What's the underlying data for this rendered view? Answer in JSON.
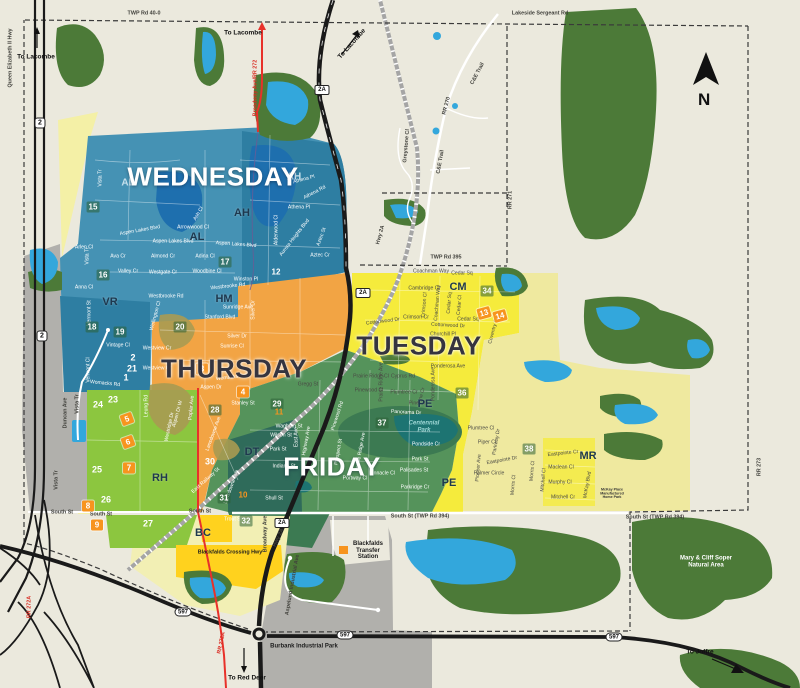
{
  "compass": {
    "label": "N"
  },
  "colors": {
    "background": "#EBE9DD",
    "forest": "#4C7A38",
    "water": "#33A7DC",
    "water_dark": "#1E6FAE",
    "pond_teal": "#1D7472",
    "wednesday": "#4592B4",
    "wednesday_dark": "#2E7EA2",
    "thursday": "#F2A444",
    "olive": "#A89B52",
    "tuesday": "#F5EB3C",
    "tuesday_pale": "#EFE99F",
    "friday": "#55935B",
    "friday_dark": "#3C7A52",
    "downtown": "#2F6B5A",
    "green_bright": "#8CC63F",
    "yellow_bright": "#FFD21E",
    "bc_pale": "#F2EFB4",
    "pale_strip": "#F4F0A6",
    "gray": "#B1B0AC",
    "road_red": "#E8312A",
    "orange_marker": "#F7941E",
    "railway": "#A5A5A5"
  },
  "day_zones": [
    {
      "id": "wednesday",
      "label": "WEDNESDAY",
      "x": 213,
      "y": 177,
      "color": "#4592B4",
      "tone": "light"
    },
    {
      "id": "thursday",
      "label": "THURSDAY",
      "x": 234,
      "y": 369,
      "color": "#F2A444",
      "tone": "dark"
    },
    {
      "id": "tuesday",
      "label": "TUESDAY",
      "x": 419,
      "y": 346,
      "color": "#F5EB3C",
      "tone": "dark"
    },
    {
      "id": "friday",
      "label": "FRIDAY",
      "x": 332,
      "y": 467,
      "color": "#55935B",
      "tone": "light"
    }
  ],
  "area_codes": [
    {
      "t": "AL",
      "x": 128,
      "y": 183,
      "style": "light"
    },
    {
      "t": "AH",
      "x": 294,
      "y": 177,
      "style": "light"
    },
    {
      "t": "AH",
      "x": 242,
      "y": 213,
      "style": "dark"
    },
    {
      "t": "AL",
      "x": 197,
      "y": 237,
      "style": "dark"
    },
    {
      "t": "VR",
      "x": 110,
      "y": 302,
      "style": "dark"
    },
    {
      "t": "HM",
      "x": 224,
      "y": 299,
      "style": "dark"
    },
    {
      "t": "RH",
      "x": 160,
      "y": 478,
      "style": "dark"
    },
    {
      "t": "DT",
      "x": 252,
      "y": 452,
      "style": "dark"
    },
    {
      "t": "BC",
      "x": 203,
      "y": 533,
      "style": "dark"
    },
    {
      "t": "PE",
      "x": 425,
      "y": 404,
      "style": "dark"
    },
    {
      "t": "PE",
      "x": 449,
      "y": 483,
      "style": "dark"
    },
    {
      "t": "CM",
      "x": 458,
      "y": 287,
      "style": "dark"
    },
    {
      "t": "MR",
      "x": 588,
      "y": 456,
      "style": "dark"
    }
  ],
  "markers": [
    {
      "t": "12",
      "x": 276,
      "y": 272,
      "style": "teal"
    },
    {
      "t": "15",
      "x": 93,
      "y": 207,
      "style": "park"
    },
    {
      "t": "16",
      "x": 103,
      "y": 275,
      "style": "park"
    },
    {
      "t": "17",
      "x": 225,
      "y": 262,
      "style": "park"
    },
    {
      "t": "18",
      "x": 92,
      "y": 327,
      "style": "park"
    },
    {
      "t": "19",
      "x": 120,
      "y": 332,
      "style": "park"
    },
    {
      "t": "20",
      "x": 180,
      "y": 327,
      "style": "park"
    },
    {
      "t": "28",
      "x": 215,
      "y": 410,
      "style": "park"
    },
    {
      "t": "29",
      "x": 277,
      "y": 404,
      "style": "park"
    },
    {
      "t": "31",
      "x": 224,
      "y": 498,
      "style": "park"
    },
    {
      "t": "32",
      "x": 246,
      "y": 521,
      "style": "park"
    },
    {
      "t": "34",
      "x": 487,
      "y": 291,
      "style": "park"
    },
    {
      "t": "36",
      "x": 462,
      "y": 393,
      "style": "park"
    },
    {
      "t": "37",
      "x": 382,
      "y": 423,
      "style": "park"
    },
    {
      "t": "38",
      "x": 529,
      "y": 449,
      "style": "park"
    },
    {
      "t": "1",
      "x": 126,
      "y": 377,
      "style": "plain"
    },
    {
      "t": "2",
      "x": 133,
      "y": 357,
      "style": "plain"
    },
    {
      "t": "21",
      "x": 132,
      "y": 368,
      "style": "plain"
    },
    {
      "t": "23",
      "x": 113,
      "y": 399,
      "style": "plain"
    },
    {
      "t": "24",
      "x": 98,
      "y": 404,
      "style": "plain"
    },
    {
      "t": "25",
      "x": 97,
      "y": 469,
      "style": "plain"
    },
    {
      "t": "26",
      "x": 106,
      "y": 499,
      "style": "plain"
    },
    {
      "t": "27",
      "x": 148,
      "y": 523,
      "style": "plain"
    },
    {
      "t": "30",
      "x": 210,
      "y": 461,
      "style": "plain"
    },
    {
      "t": "3",
      "x": 202,
      "y": 369,
      "style": "orange"
    },
    {
      "t": "4",
      "x": 243,
      "y": 392,
      "style": "orange"
    },
    {
      "t": "5",
      "x": 127,
      "y": 419,
      "style": "orange",
      "r": -20
    },
    {
      "t": "6",
      "x": 128,
      "y": 442,
      "style": "orange",
      "r": -20
    },
    {
      "t": "7",
      "x": 129,
      "y": 468,
      "style": "orange"
    },
    {
      "t": "8",
      "x": 88,
      "y": 506,
      "style": "orange"
    },
    {
      "t": "9",
      "x": 97,
      "y": 525,
      "style": "orange"
    },
    {
      "t": "13",
      "x": 484,
      "y": 313,
      "style": "orange",
      "r": -15
    },
    {
      "t": "14",
      "x": 500,
      "y": 316,
      "style": "orange",
      "r": -15
    },
    {
      "t": "10",
      "x": 243,
      "y": 495,
      "style": "otext"
    },
    {
      "t": "11",
      "x": 279,
      "y": 412,
      "style": "otext"
    }
  ],
  "badges": [
    {
      "t": "2",
      "x": 40,
      "y": 123,
      "shape": "sq"
    },
    {
      "t": "2",
      "x": 42,
      "y": 336,
      "shape": "sq"
    },
    {
      "t": "2A",
      "x": 322,
      "y": 90,
      "shape": "rect"
    },
    {
      "t": "2A",
      "x": 363,
      "y": 293,
      "shape": "rect"
    },
    {
      "t": "2A",
      "x": 282,
      "y": 523,
      "shape": "rect"
    },
    {
      "t": "597",
      "x": 183,
      "y": 612,
      "shape": "oval"
    },
    {
      "t": "597",
      "x": 345,
      "y": 635,
      "shape": "oval"
    },
    {
      "t": "597",
      "x": 614,
      "y": 637,
      "shape": "oval"
    }
  ],
  "road_labels": [
    {
      "t": "Queen Elizabeth II Hwy",
      "x": 11,
      "y": 58,
      "r": -90
    },
    {
      "t": "TWP Rd 40-0",
      "x": 144,
      "y": 14
    },
    {
      "t": "Lakeside Sergeant Rd",
      "x": 540,
      "y": 14
    },
    {
      "t": "TWP Rd 395",
      "x": 446,
      "y": 258
    },
    {
      "t": "RR 271",
      "x": 511,
      "y": 200,
      "r": -90
    },
    {
      "t": "RR 273",
      "x": 760,
      "y": 467,
      "r": -90
    },
    {
      "t": "RR 270",
      "x": 447,
      "y": 106,
      "r": -75
    },
    {
      "t": "C&E Trail",
      "x": 478,
      "y": 74,
      "r": -62
    },
    {
      "t": "C&E Trail",
      "x": 441,
      "y": 162,
      "r": -80
    },
    {
      "t": "Greystone Cl",
      "x": 407,
      "y": 146,
      "r": -85
    },
    {
      "t": "Hwy 2A",
      "x": 381,
      "y": 235,
      "r": -75
    },
    {
      "t": "Hwy 2A",
      "x": 279,
      "y": 538,
      "r": -65
    },
    {
      "t": "South St",
      "x": 62,
      "y": 513
    },
    {
      "t": "South St",
      "x": 101,
      "y": 515
    },
    {
      "t": "South St",
      "x": 200,
      "y": 512
    },
    {
      "t": "South St (TWP Rd 394)",
      "x": 420,
      "y": 517
    },
    {
      "t": "South St (TWP Rd 394)",
      "x": 655,
      "y": 518
    },
    {
      "t": "Duncan Ave",
      "x": 66,
      "y": 413,
      "r": -90
    },
    {
      "t": "Vista Tr",
      "x": 78,
      "y": 404,
      "r": -90
    },
    {
      "t": "Vista Tr",
      "x": 57,
      "y": 480,
      "r": -90
    },
    {
      "t": "Broadway Ave/RR 272",
      "x": 256,
      "y": 88,
      "r": -90,
      "c": "r"
    },
    {
      "t": "RR 272A",
      "x": 222,
      "y": 643,
      "r": -78,
      "c": "r"
    },
    {
      "t": "RR 272A",
      "x": 30,
      "y": 607,
      "r": -90,
      "c": "r"
    },
    {
      "t": "Broadway Ave",
      "x": 266,
      "y": 534,
      "r": -90
    },
    {
      "t": "Aspelund Industrial Ave",
      "x": 293,
      "y": 585,
      "r": -80
    },
    {
      "t": "Blackfalds Crossing Hwy",
      "x": 230,
      "y": 553,
      "c": "poi"
    }
  ],
  "pois": [
    {
      "t": "Blackfalds\nTransfer\nStation",
      "x": 368,
      "y": 551,
      "c": "poi"
    },
    {
      "t": "Burbank Industrial Park",
      "x": 304,
      "y": 647,
      "c": "poi"
    },
    {
      "t": "Mary & Cliff Soper\nNatural Area",
      "x": 706,
      "y": 562,
      "c": "poi-w"
    },
    {
      "t": "Centennial\nPark",
      "x": 424,
      "y": 427,
      "c": "poi-teal"
    },
    {
      "t": "McKay Place\nManufactured\nHome Park",
      "x": 612,
      "y": 494,
      "c": "poi-tiny",
      "k": 0.6
    }
  ],
  "directions": [
    {
      "t": "To Lacombe",
      "x": 36,
      "y": 57
    },
    {
      "t": "To Lacombe",
      "x": 243,
      "y": 33
    },
    {
      "t": "To Lacombe",
      "x": 352,
      "y": 44,
      "r": -48
    },
    {
      "t": "To Red Deer",
      "x": 247,
      "y": 678
    },
    {
      "t": "To Joffre",
      "x": 700,
      "y": 652
    }
  ],
  "streets": [
    {
      "t": "Vista Tr",
      "x": 101,
      "y": 178,
      "r": -90
    },
    {
      "t": "Vista Tr",
      "x": 88,
      "y": 256,
      "r": -90
    },
    {
      "t": "Anna Cl",
      "x": 84,
      "y": 288
    },
    {
      "t": "Arlen Cl",
      "x": 84,
      "y": 248
    },
    {
      "t": "Ava Cr",
      "x": 118,
      "y": 257
    },
    {
      "t": "Valley Cr",
      "x": 128,
      "y": 272
    },
    {
      "t": "Westgate Cr",
      "x": 163,
      "y": 273
    },
    {
      "t": "Almond Cr",
      "x": 163,
      "y": 257
    },
    {
      "t": "Adina Cl",
      "x": 205,
      "y": 257
    },
    {
      "t": "Woodbine Cl",
      "x": 207,
      "y": 272
    },
    {
      "t": "Arrowwood Cl",
      "x": 193,
      "y": 228
    },
    {
      "t": "Ash Cl",
      "x": 199,
      "y": 214,
      "r": -60
    },
    {
      "t": "Aspen Lakes Blvd",
      "x": 140,
      "y": 231,
      "r": -10
    },
    {
      "t": "Aspen Lakes Blvd",
      "x": 173,
      "y": 242
    },
    {
      "t": "Aspen Lakes Blvd",
      "x": 236,
      "y": 245,
      "r": 4
    },
    {
      "t": "Winston Pl",
      "x": 246,
      "y": 280
    },
    {
      "t": "Westbrooke Rd",
      "x": 166,
      "y": 297
    },
    {
      "t": "Westbrooke Rd",
      "x": 228,
      "y": 287,
      "r": -6
    },
    {
      "t": "Athena Pl",
      "x": 299,
      "y": 208
    },
    {
      "t": "Athena Pl",
      "x": 304,
      "y": 180,
      "r": -15
    },
    {
      "t": "Athena Rd",
      "x": 315,
      "y": 193,
      "r": -28
    },
    {
      "t": "Aurora Heights Blvd",
      "x": 295,
      "y": 238,
      "r": -52
    },
    {
      "t": "Aztec St",
      "x": 322,
      "y": 237,
      "r": -70
    },
    {
      "t": "Aztec Cr",
      "x": 320,
      "y": 256
    },
    {
      "t": "Alderwood Cl",
      "x": 277,
      "y": 230,
      "r": -90
    },
    {
      "t": "Vermont St",
      "x": 90,
      "y": 313,
      "r": -90
    },
    {
      "t": "Vermont Cl",
      "x": 89,
      "y": 370,
      "r": -90
    },
    {
      "t": "Vintage Cl",
      "x": 118,
      "y": 346
    },
    {
      "t": "Wellington Cl",
      "x": 156,
      "y": 316,
      "r": -75
    },
    {
      "t": "Womacks Rd",
      "x": 105,
      "y": 384,
      "r": 6
    },
    {
      "t": "Womacks Rd",
      "x": 231,
      "y": 378,
      "r": -6
    },
    {
      "t": "Sunridge Ave",
      "x": 238,
      "y": 308
    },
    {
      "t": "Stanford Blvd",
      "x": 220,
      "y": 318
    },
    {
      "t": "Silver Dr",
      "x": 237,
      "y": 337
    },
    {
      "t": "Sunrise Cl",
      "x": 232,
      "y": 347
    },
    {
      "t": "Silver Dr",
      "x": 254,
      "y": 310,
      "r": -90
    },
    {
      "t": "Westview Cr",
      "x": 157,
      "y": 349
    },
    {
      "t": "Westview Cr",
      "x": 157,
      "y": 369
    },
    {
      "t": "Aspen Dr",
      "x": 211,
      "y": 388
    },
    {
      "t": "Aspen Dr W",
      "x": 178,
      "y": 414,
      "r": -75
    },
    {
      "t": "Poplar Ave",
      "x": 192,
      "y": 408,
      "r": -85
    },
    {
      "t": "Stanley St",
      "x": 243,
      "y": 404
    },
    {
      "t": "Lansdowne Ave",
      "x": 214,
      "y": 434,
      "r": -70
    },
    {
      "t": "Leung Rd",
      "x": 147,
      "y": 406,
      "r": -90
    },
    {
      "t": "Westridge Dr",
      "x": 170,
      "y": 427,
      "r": -78
    },
    {
      "t": "Gregg St",
      "x": 308,
      "y": 385,
      "c": "d"
    },
    {
      "t": "Waghorn St",
      "x": 289,
      "y": 427
    },
    {
      "t": "Wilson St",
      "x": 281,
      "y": 436
    },
    {
      "t": "Park St",
      "x": 278,
      "y": 450
    },
    {
      "t": "Indiana St",
      "x": 284,
      "y": 467
    },
    {
      "t": "Shull St",
      "x": 274,
      "y": 499
    },
    {
      "t": "East Ave",
      "x": 297,
      "y": 437,
      "r": -90
    },
    {
      "t": "Highway Ave",
      "x": 307,
      "y": 441,
      "r": -80
    },
    {
      "t": "East Railway St",
      "x": 206,
      "y": 481,
      "r": -42
    },
    {
      "t": "Lansdowne Ave",
      "x": 232,
      "y": 487,
      "r": -70
    },
    {
      "t": "Trout St",
      "x": 233,
      "y": 520
    },
    {
      "t": "Panorama Dr",
      "x": 406,
      "y": 413,
      "r": 3
    },
    {
      "t": "Pondside Cr",
      "x": 426,
      "y": 445
    },
    {
      "t": "Park St",
      "x": 420,
      "y": 460
    },
    {
      "t": "Palisades St",
      "x": 414,
      "y": 471
    },
    {
      "t": "Parkridge Cr",
      "x": 415,
      "y": 488
    },
    {
      "t": "Pinnacle Cl",
      "x": 382,
      "y": 474
    },
    {
      "t": "Portway Cl",
      "x": 355,
      "y": 479
    },
    {
      "t": "Pinewood Rd",
      "x": 338,
      "y": 416,
      "r": -72
    },
    {
      "t": "Prairie Ridge Ave",
      "x": 361,
      "y": 452,
      "r": -80
    },
    {
      "t": "Prospect St",
      "x": 339,
      "y": 452,
      "r": -80
    },
    {
      "t": "Coachman Way",
      "x": 431,
      "y": 272,
      "c": "d"
    },
    {
      "t": "Cedar Sq",
      "x": 462,
      "y": 274,
      "c": "d"
    },
    {
      "t": "Cambridge Cl",
      "x": 424,
      "y": 289,
      "c": "d"
    },
    {
      "t": "Crimson Cl",
      "x": 425,
      "y": 305,
      "r": -85,
      "c": "d"
    },
    {
      "t": "Crimson Cr",
      "x": 416,
      "y": 318,
      "c": "d"
    },
    {
      "t": "Coachman Way",
      "x": 438,
      "y": 303,
      "r": -85,
      "c": "d"
    },
    {
      "t": "Cedar Sq",
      "x": 450,
      "y": 303,
      "r": -85,
      "c": "d"
    },
    {
      "t": "Cedar Cl",
      "x": 460,
      "y": 305,
      "r": -85,
      "c": "d"
    },
    {
      "t": "Cedar Sq",
      "x": 468,
      "y": 320,
      "c": "d"
    },
    {
      "t": "Cottonwood Dr",
      "x": 383,
      "y": 322,
      "r": -7,
      "c": "d"
    },
    {
      "t": "Cottonwood Dr",
      "x": 448,
      "y": 326,
      "r": 3,
      "c": "d"
    },
    {
      "t": "Churchill Pl",
      "x": 443,
      "y": 335,
      "c": "d"
    },
    {
      "t": "Coventry Cl",
      "x": 494,
      "y": 331,
      "r": -75,
      "c": "d"
    },
    {
      "t": "Ponderosa Ave",
      "x": 448,
      "y": 367,
      "c": "d"
    },
    {
      "t": "Ponderosa Ave",
      "x": 434,
      "y": 384,
      "r": -90,
      "c": "d"
    },
    {
      "t": "Cyprus Rd",
      "x": 403,
      "y": 377,
      "c": "d"
    },
    {
      "t": "Prairie Ridge Ave",
      "x": 382,
      "y": 382,
      "r": -90,
      "c": "d"
    },
    {
      "t": "Prairie Ridge Cl",
      "x": 371,
      "y": 377,
      "c": "d"
    },
    {
      "t": "Pinewood Cl",
      "x": 369,
      "y": 391,
      "c": "d"
    },
    {
      "t": "Plumtree Cr",
      "x": 404,
      "y": 393,
      "c": "d"
    },
    {
      "t": "Pine Cr",
      "x": 422,
      "y": 396,
      "r": -75,
      "c": "d"
    },
    {
      "t": "Pine Cl",
      "x": 417,
      "y": 404,
      "c": "d"
    },
    {
      "t": "Plumtree Cl",
      "x": 481,
      "y": 429,
      "c": "d"
    },
    {
      "t": "Piper Cl",
      "x": 487,
      "y": 443,
      "c": "d"
    },
    {
      "t": "Parkway Dr",
      "x": 497,
      "y": 442,
      "r": -80,
      "c": "d"
    },
    {
      "t": "Eastpointe Dr",
      "x": 502,
      "y": 461,
      "r": -10,
      "c": "d"
    },
    {
      "t": "Palmer Circle",
      "x": 489,
      "y": 474,
      "c": "d"
    },
    {
      "t": "Pioneer Ave",
      "x": 479,
      "y": 468,
      "r": -85,
      "c": "d"
    },
    {
      "t": "Morris Cl",
      "x": 514,
      "y": 485,
      "r": -85,
      "c": "d"
    },
    {
      "t": "Eastpointe Cr",
      "x": 563,
      "y": 454,
      "r": -6,
      "c": "d"
    },
    {
      "t": "Maclean Cl",
      "x": 561,
      "y": 468,
      "c": "d"
    },
    {
      "t": "Murphy Cl",
      "x": 560,
      "y": 483,
      "c": "d"
    },
    {
      "t": "Mitchell Cr",
      "x": 563,
      "y": 498,
      "c": "d"
    },
    {
      "t": "Morris Cl",
      "x": 533,
      "y": 471,
      "r": -85,
      "c": "d"
    },
    {
      "t": "Mitchell Cl",
      "x": 544,
      "y": 480,
      "r": -85,
      "c": "d"
    },
    {
      "t": "McKay Blvd",
      "x": 588,
      "y": 485,
      "r": -80,
      "c": "d"
    }
  ]
}
